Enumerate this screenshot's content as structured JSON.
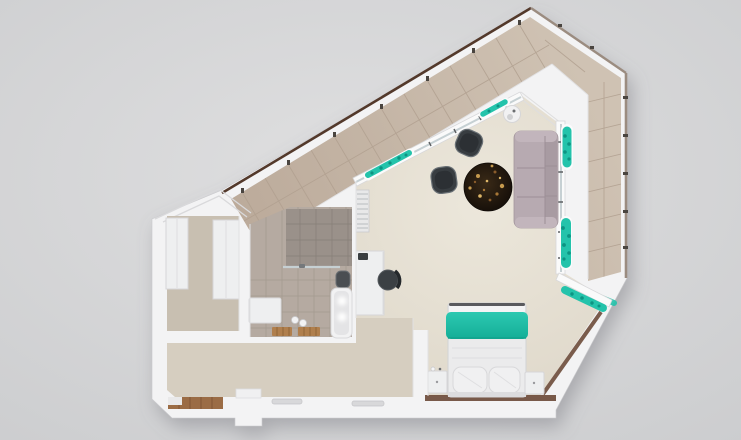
{
  "scene": {
    "description": "top-down 3d render of a studio apartment floor plan",
    "rooms": [
      "balcony",
      "living-room",
      "sleeping-area",
      "bathroom",
      "walk-in-closet",
      "hallway"
    ],
    "furniture": [
      "sofa",
      "coffee-table",
      "armchair-upper",
      "armchair-lower",
      "desk",
      "office-chair",
      "radiator",
      "double-bed",
      "nightstand-left",
      "nightstand-right",
      "wardrobe-left",
      "wardrobe-right",
      "vanity",
      "bathtub",
      "toilet",
      "bath-mats",
      "planter-boxes",
      "side-table",
      "entry-parquet"
    ]
  },
  "colors": {
    "background_center": "#dfdfe0",
    "background_edge": "#cccdcf",
    "wall": "#f3f3f4",
    "wall_seam": "#dcdcdf",
    "balcony_floor_light": "#cfc2b3",
    "balcony_floor_dark": "#bcab9b",
    "balcony_tile_line": "#b1a090",
    "railing_dark": "#53392b",
    "railing_light": "#9b8c80",
    "living_floor_light": "#ece7db",
    "living_floor_dark": "#ddd6c8",
    "hall_floor": "#d6cec0",
    "closet_floor": "#c8bfb1",
    "bathroom_tile": "#b5aaa1",
    "bathroom_grid": "#9e948b",
    "shower_tile": "#9a918a",
    "shower_grid": "#857d76",
    "glass": "#c6d0d3",
    "sofa": "#b7aab1",
    "sofa_seam": "#9c8f96",
    "sofa_back": "#a89ba2",
    "armchair": "#383d41",
    "armchair_rim": "#697075",
    "table_dark": "#130d08",
    "table_mid": "#3a2a17",
    "table_gold": "#c59a4e",
    "teal": "#24c3ab",
    "teal_deep": "#0d9483",
    "teal_bright": "#2cc9b1",
    "bed_teal_deep": "#14ae97",
    "bed_linen": "#ebebec",
    "pillow": "#f0f0f1",
    "wood_floor": "#9b6c45",
    "wood_plank_line": "#7e5434",
    "baseboard_wood": "#6e4c3a",
    "furniture_white": "#eeeff0",
    "furniture_edge": "#d6d6d8",
    "desk_chair": "#3b4044"
  }
}
